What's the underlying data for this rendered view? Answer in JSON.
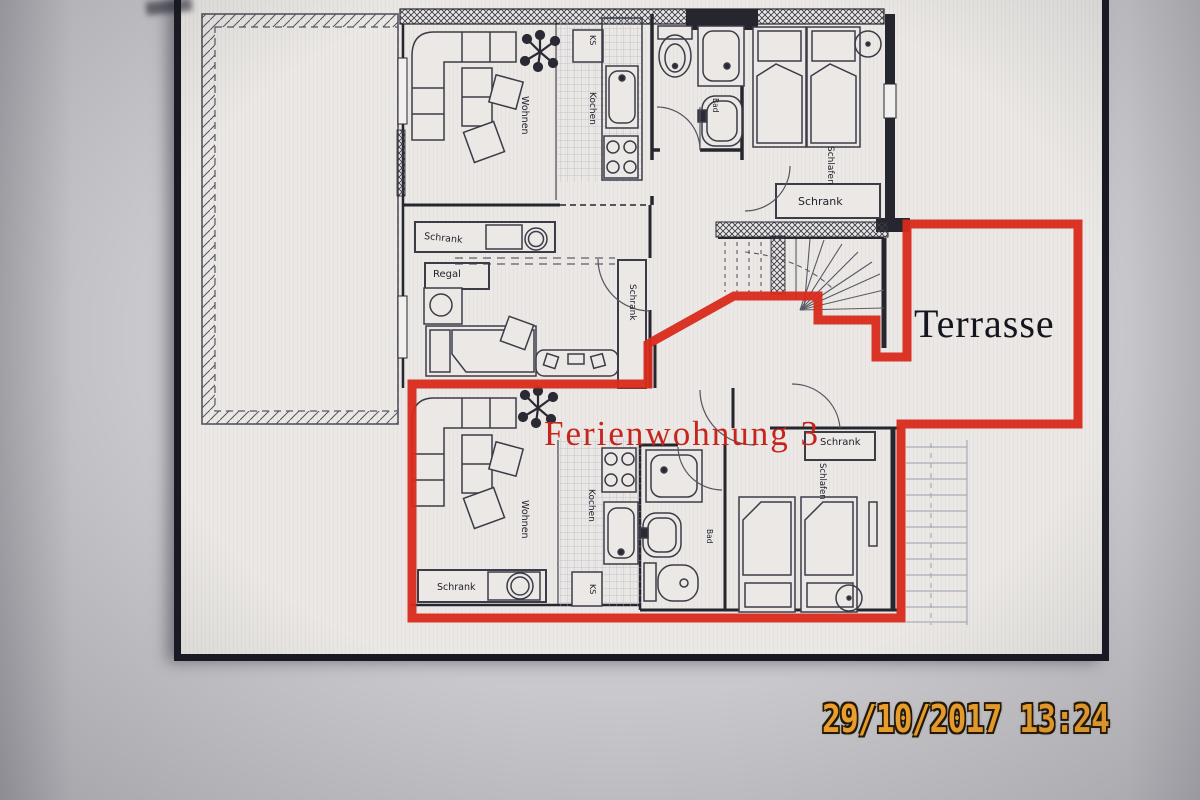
{
  "photo": {
    "camera_timestamp": "29/10/2017 13:24"
  },
  "colors": {
    "highlight_red": "#d92a1c",
    "plan_line": "#2e2e3a",
    "timestamp_orange": "#f2a32b",
    "page_background": "#ebe8e5",
    "photo_background": "#c9c8cc"
  },
  "floorplan": {
    "apartment_label": "Ferienwohnung 3",
    "terrace_label": "Terrasse",
    "rooms": {
      "upper": {
        "wohnen": "Wohnen",
        "kochen": "Kochen",
        "ks": "KS",
        "bad": "Bad",
        "schlafen": "Schlafen",
        "schrank_bedroom": "Schrank"
      },
      "middle": {
        "schrank_left": "Schrank",
        "regal": "Regal",
        "schrank_right": "Schrank"
      },
      "lower": {
        "wohnen": "Wohnen",
        "kochen": "Kochen",
        "ks": "KS",
        "bad": "Bad",
        "schlafen": "Schlafen",
        "schrank_left": "Schrank",
        "schrank_bedroom": "Schrank"
      }
    }
  }
}
